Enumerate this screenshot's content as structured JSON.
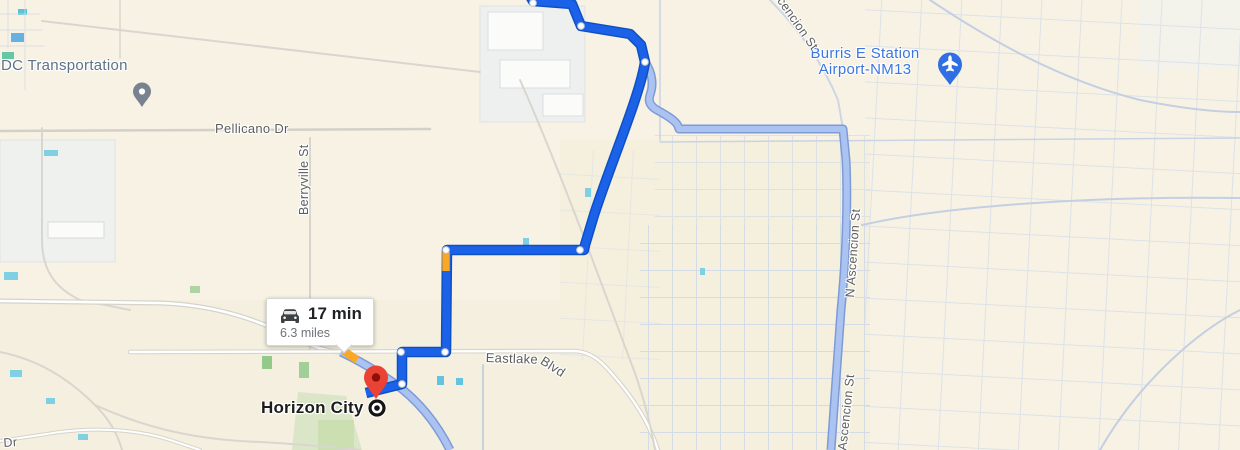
{
  "app": "google-maps-directions-view",
  "map": {
    "route_info": {
      "duration": "17 min",
      "distance": "6.3 miles",
      "vehicle_icon": "car-icon"
    },
    "labels": {
      "dc_transportation": "DC Transportation",
      "pellicano_dr": "Pellicano Dr",
      "berryville_st": "Berryville St",
      "burris_station_line1": "Burris E Station",
      "burris_station_line2": "Airport-NM13",
      "ascencion_st_top": "Ascencion St",
      "n_ascencion_st_mid": "N Ascencion St",
      "n_ascencion_st_bottom": "N Ascencion St",
      "eastlake_main": "Eastlake",
      "eastlake_suffix": "Blvd",
      "horizon_city": "Horizon City",
      "dr_corner": "Dr"
    },
    "icons": {
      "airport_marker": "airplane-icon",
      "transport_poi_marker": "gray-pin-icon",
      "destination_marker": "red-pin-icon",
      "city_marker": "bullseye-icon"
    }
  },
  "colors": {
    "map-bg": "#f7f2e4",
    "route-blue": "#1c62e8",
    "route-blue-casing": "#0d50c5",
    "alt-route-fill": "#abc3f1",
    "alt-route-casing": "#7e9bd6",
    "traffic-orange": "#f9a825",
    "destination-red": "#ea4335",
    "destination-red-dark": "#8c1007",
    "poi-blue": "#3b76e0",
    "poi-gray": "#5c7287",
    "street-label": "#5d5d5d",
    "grid-road": "#ccd6e6",
    "local-road": "#d8d6cf"
  }
}
